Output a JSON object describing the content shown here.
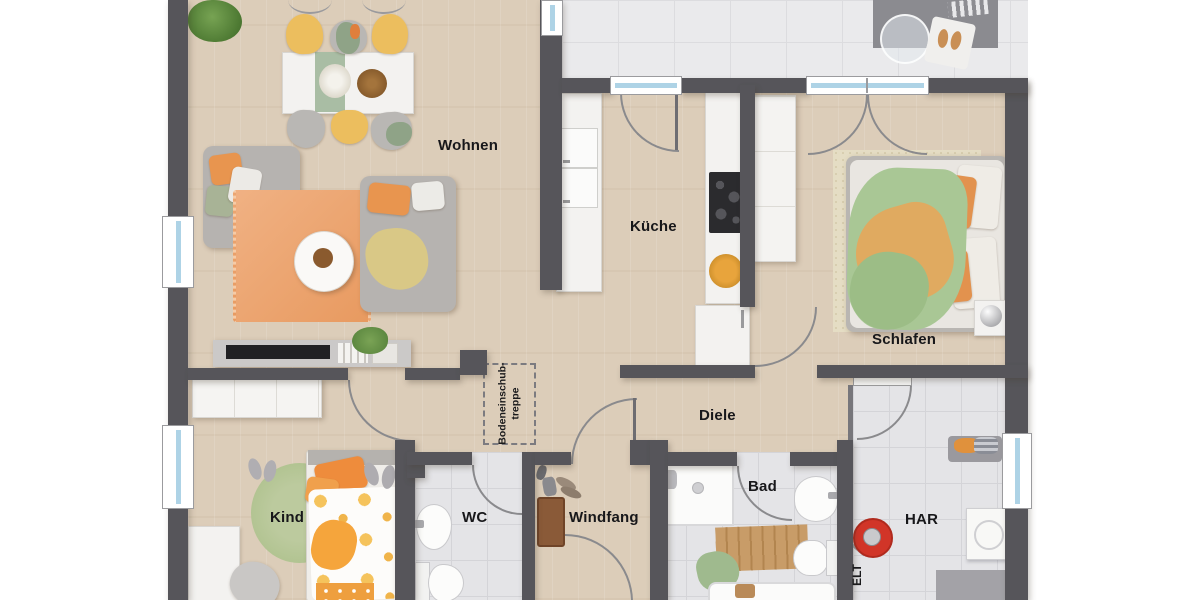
{
  "plan": {
    "type": "floor-plan",
    "language": "de",
    "rooms": [
      {
        "id": "wohnen",
        "label": "Wohnen"
      },
      {
        "id": "kueche",
        "label": "Küche"
      },
      {
        "id": "schlafen",
        "label": "Schlafen"
      },
      {
        "id": "diele",
        "label": "Diele"
      },
      {
        "id": "bad",
        "label": "Bad"
      },
      {
        "id": "kind",
        "label": "Kind"
      },
      {
        "id": "wc",
        "label": "WC"
      },
      {
        "id": "windfang",
        "label": "Windfang"
      },
      {
        "id": "har",
        "label": "HAR"
      }
    ],
    "annotations": {
      "attic_line1": "Bodeneinschub-",
      "attic_line2": "treppe",
      "electrical": "ELT"
    },
    "colors": {
      "wall": "#56555a",
      "wood-floor": "#dccdb9",
      "tile-floor": "#e4e4e7",
      "terrace-floor": "#eaeaec",
      "window-glass": "#aed3e6",
      "accent-orange": "#e8954f",
      "accent-green": "#a9c795",
      "accent-yellow": "#ecbe5e",
      "vacuum-red": "#d13528",
      "label-text": "#17171a"
    }
  }
}
